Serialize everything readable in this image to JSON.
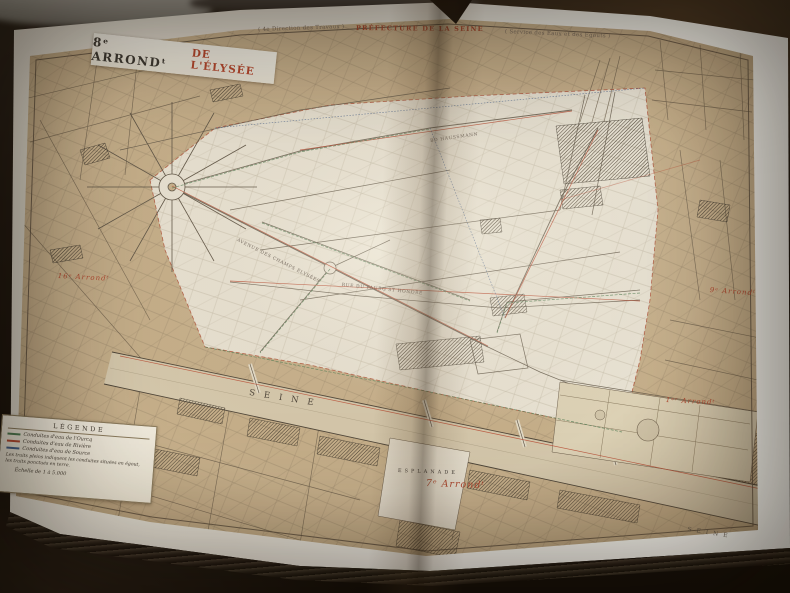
{
  "page": {
    "header_left": "( 4e Direction des Travaux )",
    "header_center": "PRÉFECTURE DE LA SEINE",
    "header_right": "( Service des Eaux et des Égouts )"
  },
  "title": {
    "number": "8ᵉ ARRONDᵗ",
    "name": "DE L'ÉLYSÉE"
  },
  "legend": {
    "title": "LÉGENDE",
    "items": [
      {
        "label": "Conduites d'eau de l'Ourcq",
        "color": "#4f7c52"
      },
      {
        "label": "Conduites d'eau de Rivière",
        "color": "#b84a31"
      },
      {
        "label": "Conduites d'eau de Source",
        "color": "#47628b"
      }
    ],
    "note": "Les traits pleins indiquent les conduites situées en égout, les traits ponctués en terre.",
    "scale": "Échelle de 1 à 5.000"
  },
  "labels": {
    "river": "SEINE",
    "river_2": "SEINE",
    "esplanade": "ESPLANADE",
    "arrond_west": "16ᵉ Arrondᵗ",
    "arrond_northeast": "9ᵉ Arrondᵗ",
    "arrond_east": "1ᵉʳ Arrondᵗ",
    "arrond_south": "7ᵉ Arrondᵗ",
    "street_champs": "AVENUE DES CHAMPS ÉLYSÉES",
    "street_haussmann": "BD HAUSSMANN",
    "street_faubourg": "RUE DU FAUBG ST HONORÉ"
  },
  "colors": {
    "accent_red": "#b0452e",
    "conduit_green": "#4f7c52",
    "conduit_blue": "#47628b",
    "paper_tan": "#c7b08b",
    "paper_highlight": "#e9e3d4"
  }
}
